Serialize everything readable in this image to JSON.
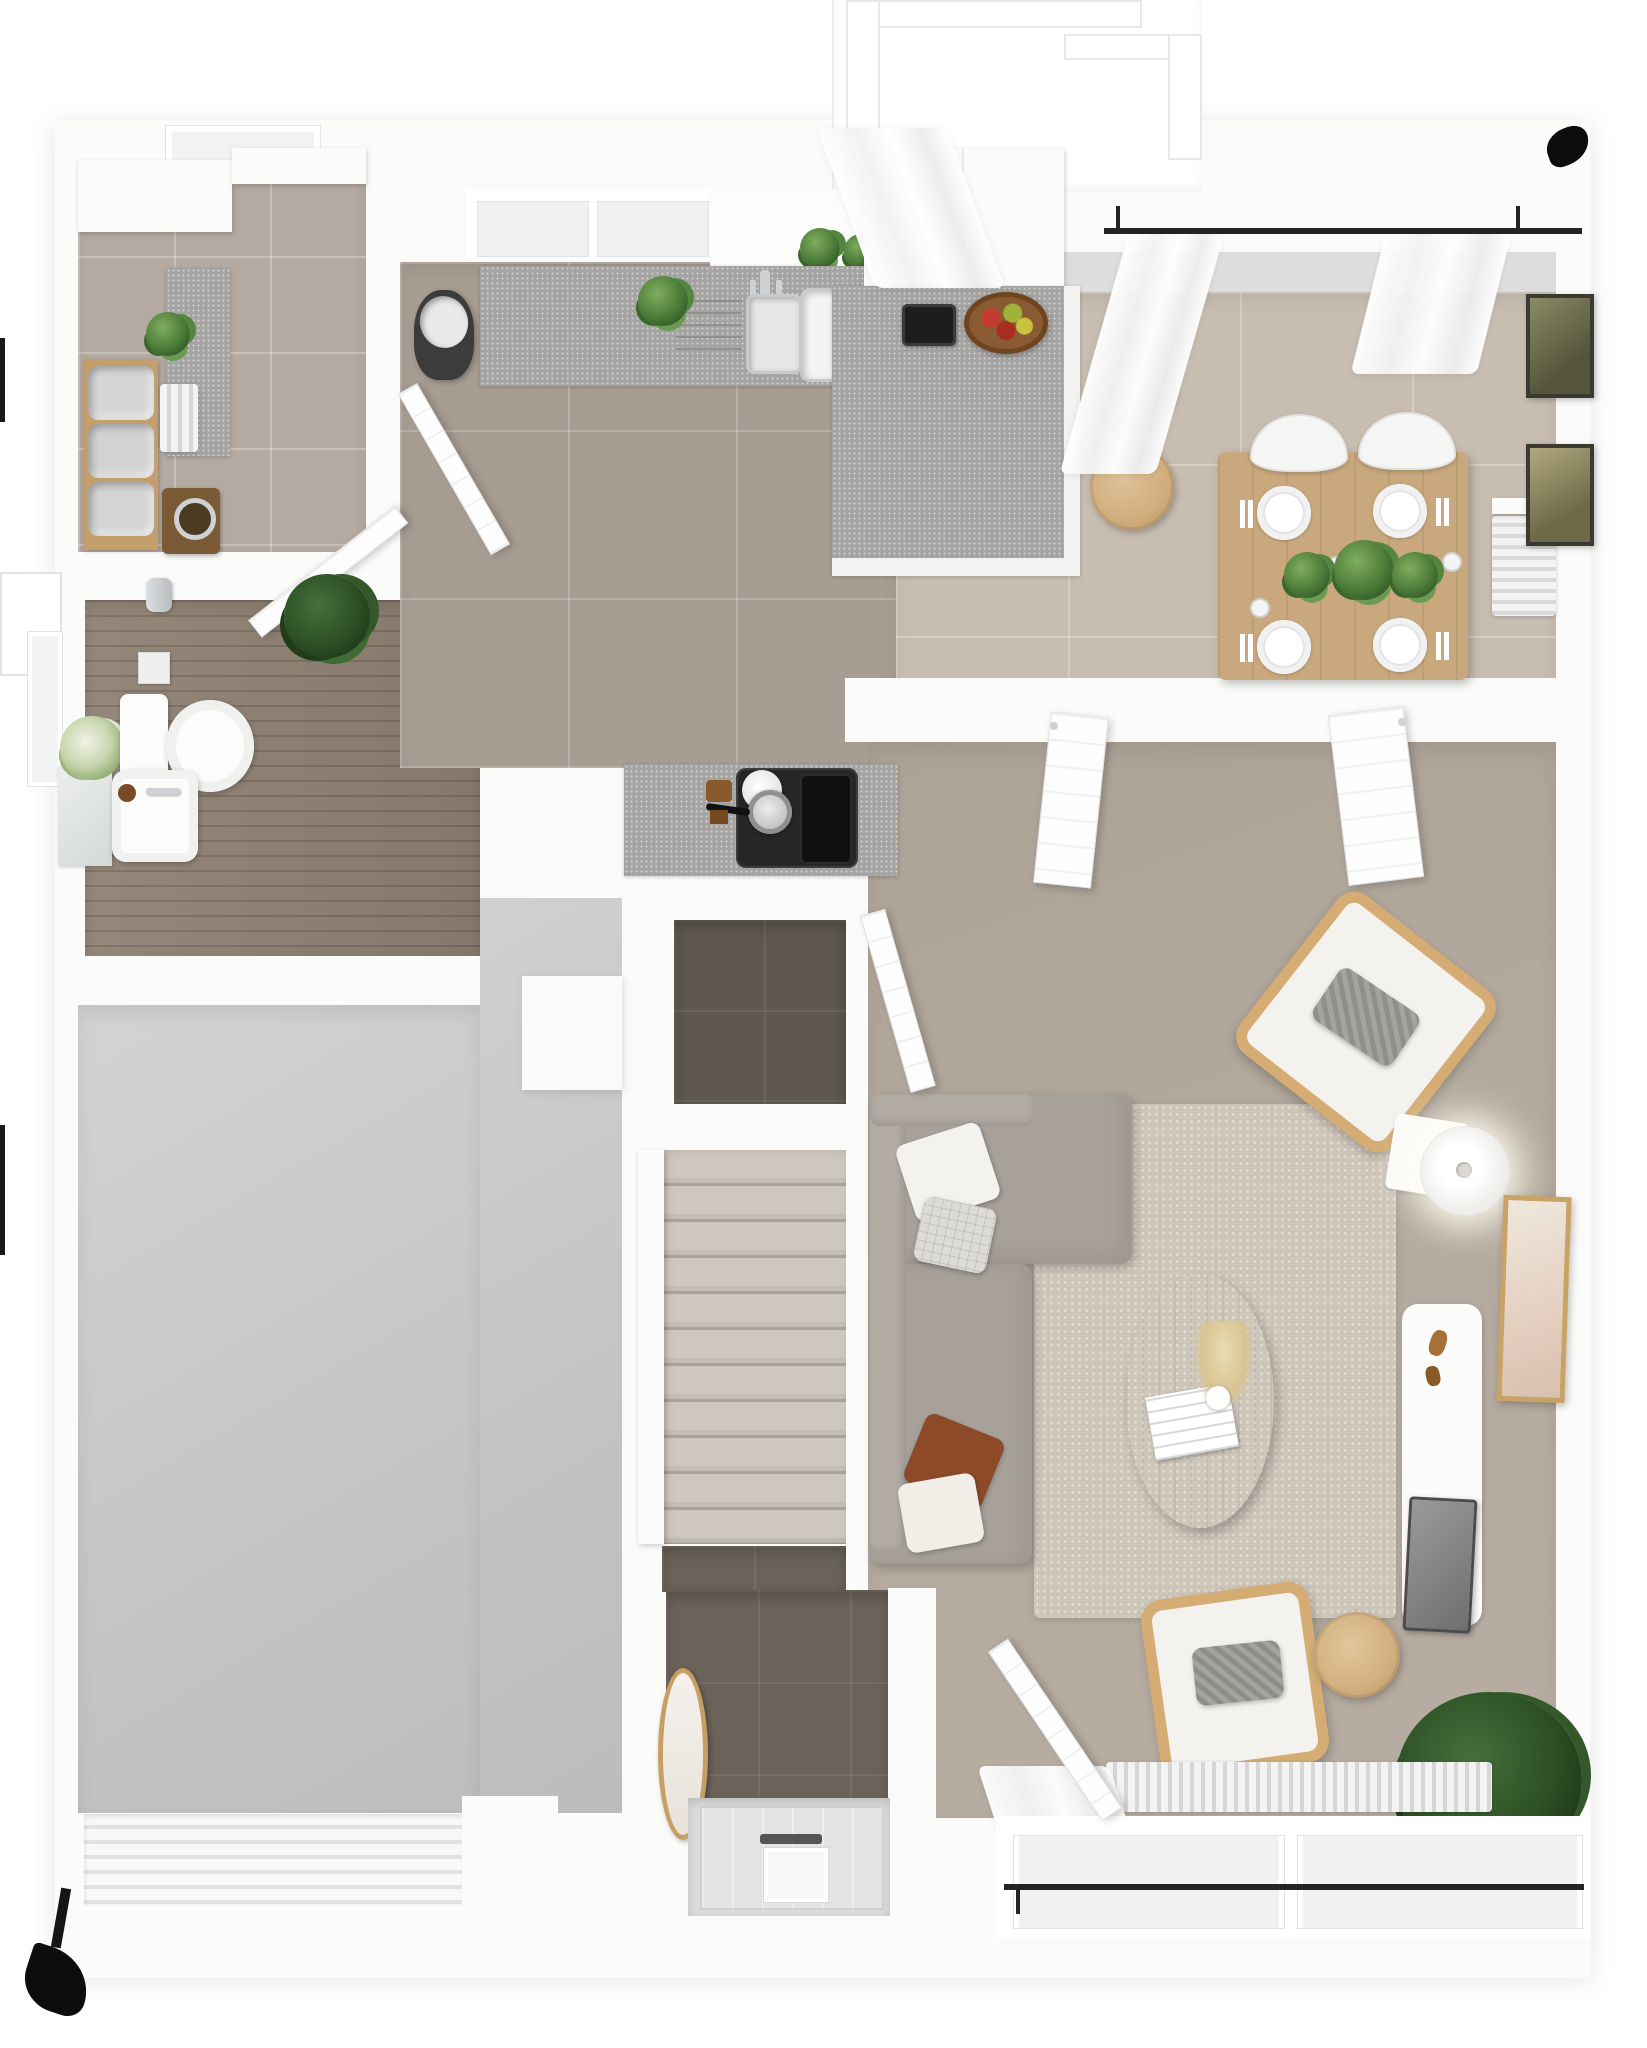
{
  "meta": {
    "title": "Ground floor – 3D top-down floor plan render",
    "style": "photoreal architectural visualization on white background",
    "no_visible_text": true
  },
  "palette": {
    "wall": "#fbfbfa",
    "kitchen_floor": "#a89d93",
    "dining_floor": "#c8bdb1",
    "utility_floor": "#b5aaa1",
    "bathroom_wood_floor": "#8e8071",
    "closet_floor": "#5f5850",
    "entry_floor": "#6b6359",
    "garage_floor": "#c6c6c6",
    "stair_tread": "#c8c2b9",
    "living_carpet": "#b3a99e",
    "rug": "#cfc6ba",
    "counter_granite": "#a5a4a2",
    "wood_furniture": "#cfa977",
    "curtain_rod": "#242424",
    "plant_green": "#4a7a38"
  },
  "rooms": {
    "utility": {
      "name": "Utility room",
      "items": [
        "window",
        "white cabinets",
        "granite side counter",
        "potted plant",
        "wood shelf with three fabric baskets",
        "vertical radiator",
        "washing machine"
      ]
    },
    "bathroom": {
      "name": "Bathroom",
      "items": [
        "window with outside planter box",
        "mirror",
        "washbasin with chrome tap",
        "flower bouquet",
        "toilet",
        "toilet paper holder",
        "toilet brush",
        "open door"
      ]
    },
    "hallway": {
      "name": "Hallway",
      "items": [
        "wood plank floor",
        "dark green plant"
      ]
    },
    "kitchen": {
      "name": "Kitchen",
      "items": [
        "two windows",
        "herb pots on sill",
        "granite worktop with double chrome sink and drainer grooves",
        "worktop plant",
        "tall white cabinet block",
        "granite peninsula with coffee machine and fruit bowl",
        "two round wooden bar stools",
        "laundry hamper",
        "open door",
        "lower worktop with black cooktop, kettle, pot and griddle",
        "utensil jar"
      ]
    },
    "dining": {
      "name": "Dining area",
      "items": [
        "wooden four-seat table",
        "four white plates with cutlery",
        "three glasses",
        "three table plants",
        "four white chairs",
        "wall radiator",
        "two framed botanical prints"
      ]
    },
    "balcony": {
      "name": "Balcony",
      "items": [
        "white railing frames",
        "black curtain rod",
        "sheer white curtains",
        "black downpipe mark"
      ]
    },
    "living": {
      "name": "Living room",
      "steps": null,
      "items": [
        "grey L-shaped sofa with chaise",
        "four throw pillows",
        "shaggy rug",
        "oval wooden coffee table with magazine and pampas vase",
        "wooden armchair with grey cushion (upper)",
        "glowing floor lamp",
        "leaning framed artwork",
        "white TV sideboard with wooden decor and TV panel",
        "wooden armchair with grey cushion (lower)",
        "round wooden side table",
        "large monstera plant",
        "radiator under window",
        "sheer curtain with black rod",
        "window band",
        "open door from entrance"
      ]
    },
    "closet": {
      "name": "Storage closet",
      "items": [
        "dark tile floor",
        "open door"
      ]
    },
    "staircase": {
      "name": "Staircase",
      "steps": 11,
      "items": [
        "white handrail wall",
        "treads descending to entrance"
      ]
    },
    "entrance": {
      "name": "Entrance hall",
      "items": [
        "dark tile floor",
        "oval wooden wall mirror",
        "front door with glazing and letterbox"
      ]
    },
    "garage": {
      "name": "Garage",
      "items": [
        "concrete floor",
        "structural pillar",
        "ribbed garage door",
        "black door swing mark"
      ]
    }
  }
}
